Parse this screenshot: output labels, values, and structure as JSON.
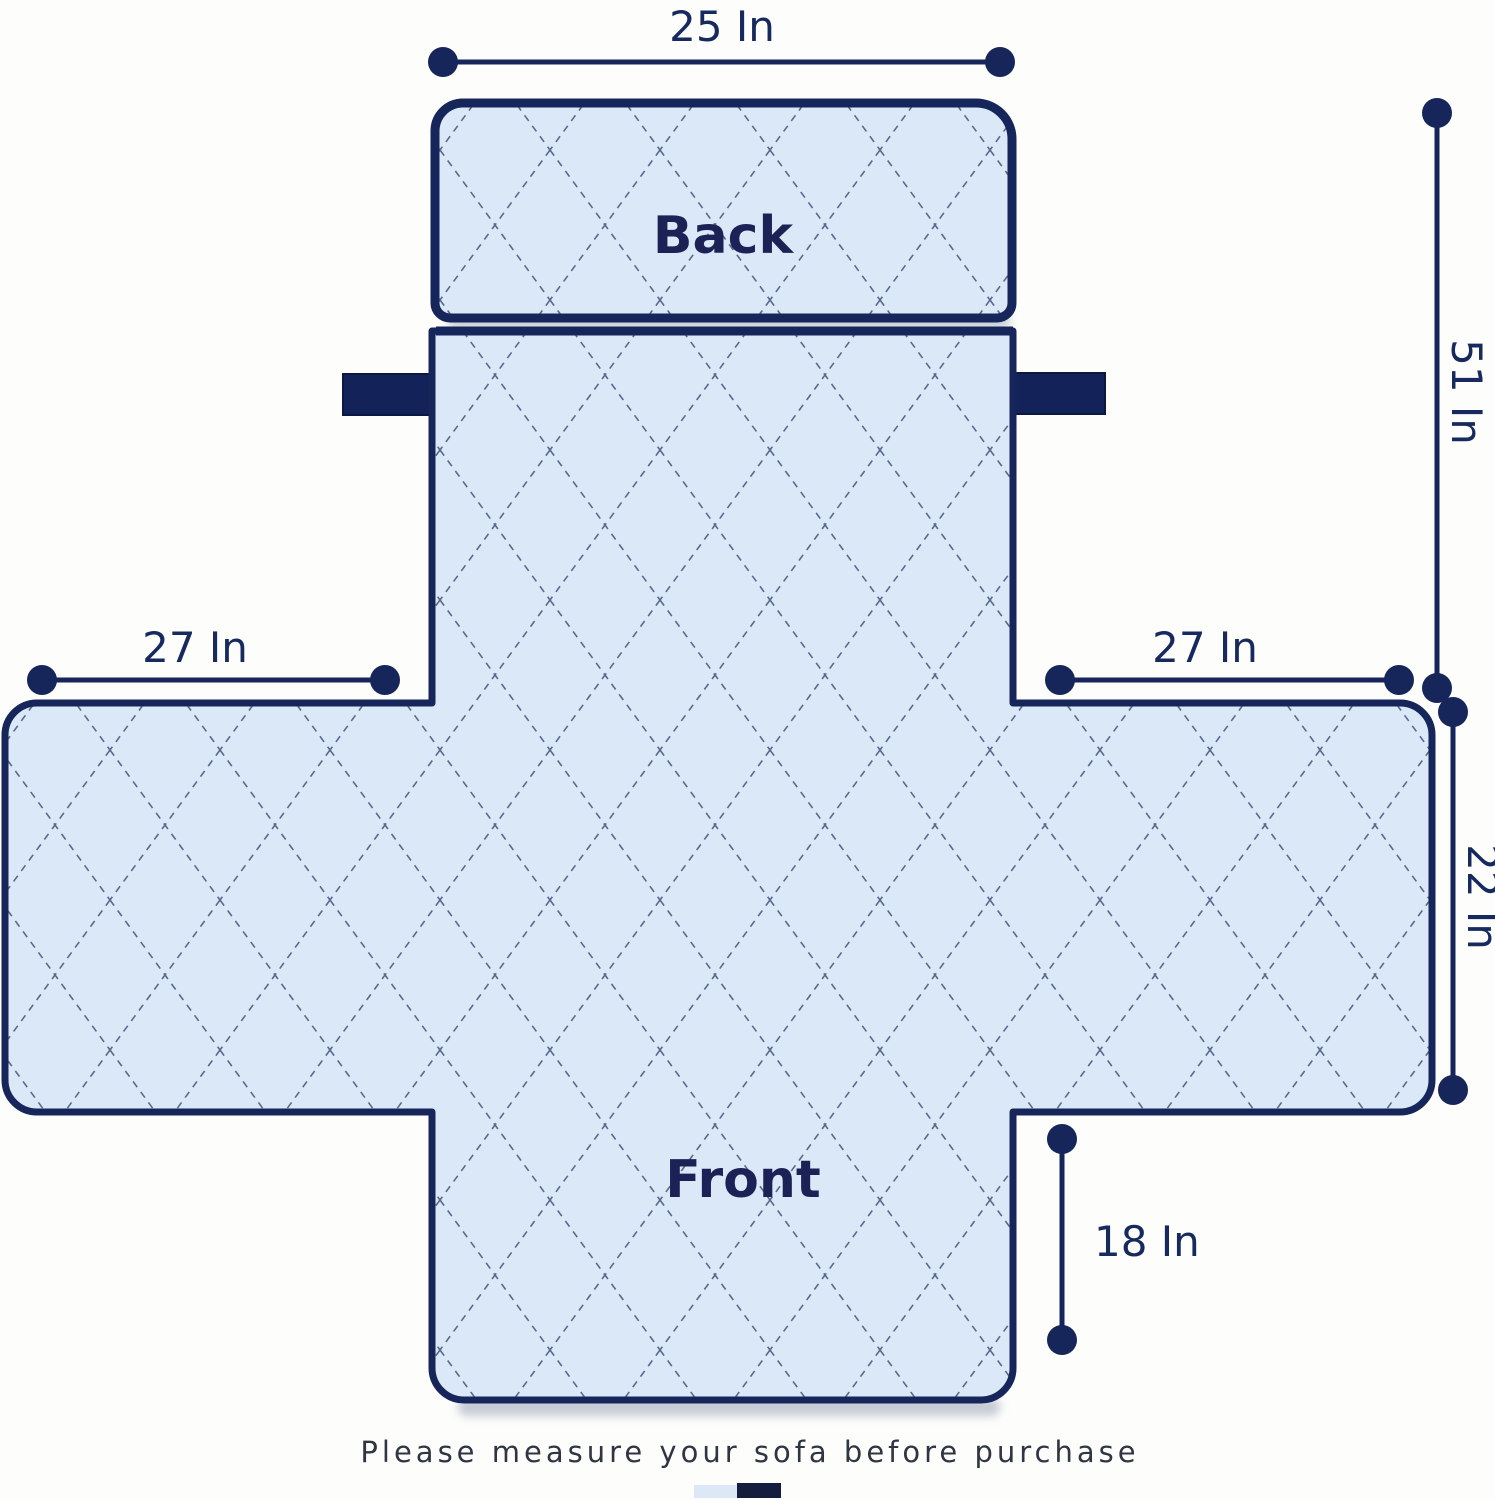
{
  "diagram": {
    "type": "sofa-cover-measurement-diagram",
    "back_label": "Back",
    "front_label": "Front",
    "dims": {
      "top_width": "25 In",
      "total_height": "51 In",
      "left_arm_width": "27 In",
      "right_arm_width": "27 In",
      "side_height": "22 In",
      "front_skirt_height": "18 In"
    },
    "caption": "Please measure your sofa before purchase",
    "colors": {
      "navy_line": "#16255a",
      "quilt_fill": "#dbe8f7",
      "quilt_stitch": "#4a5c80",
      "strap_navy": "#132258",
      "caption_text": "#2f3542"
    },
    "swatches": [
      "#dce8f5",
      "#141d3e"
    ]
  }
}
